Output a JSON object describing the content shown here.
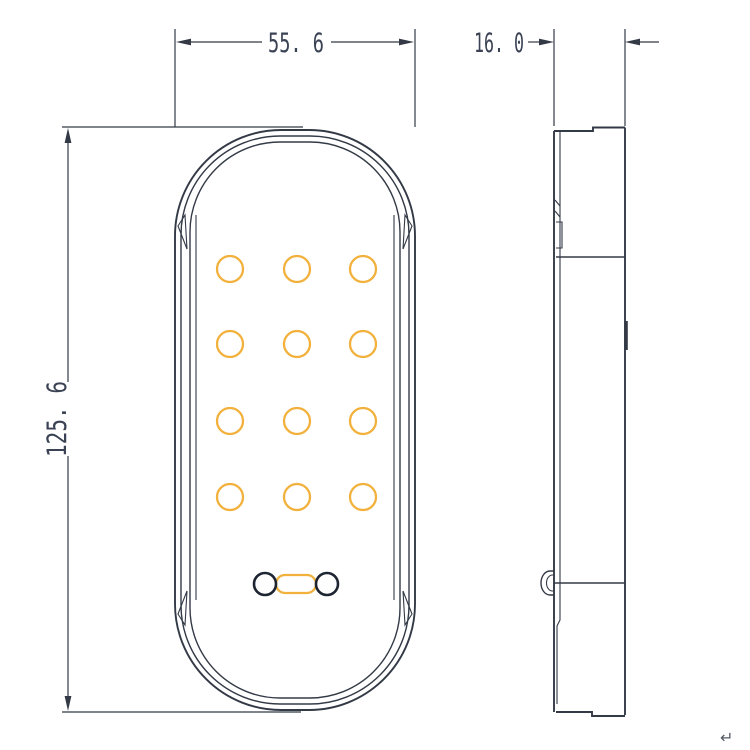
{
  "drawing": {
    "title": "led-lamp-technical-drawing",
    "colors": {
      "paper": "#ffffff",
      "ink": "#333a46",
      "amber": "#f2b13c",
      "connector": "#1d2532",
      "dim_text": "#3a4254",
      "glyph_gray": "#555b66"
    },
    "dimensions": {
      "width_front": {
        "label": "55. 6",
        "unit_note": "front view overall width"
      },
      "depth_side": {
        "label": "16. 0",
        "unit_note": "side view overall depth"
      },
      "height_front": {
        "label": "125. 6",
        "unit_note": "front view overall height"
      }
    },
    "led_grid": {
      "count": 12,
      "rows": 4,
      "cols": 3,
      "col_x": [
        230,
        297,
        363
      ],
      "row_y": [
        269,
        344,
        421,
        497
      ],
      "radius": 13
    },
    "connector": {
      "left_hole": {
        "cx": 265,
        "cy": 584,
        "r": 11
      },
      "right_hole": {
        "cx": 327,
        "cy": 584,
        "r": 11
      },
      "pad": {
        "x": 276,
        "y": 575,
        "w": 40,
        "h": 18,
        "rx": 9
      }
    },
    "misc": {
      "return_glyph": "↵"
    }
  }
}
